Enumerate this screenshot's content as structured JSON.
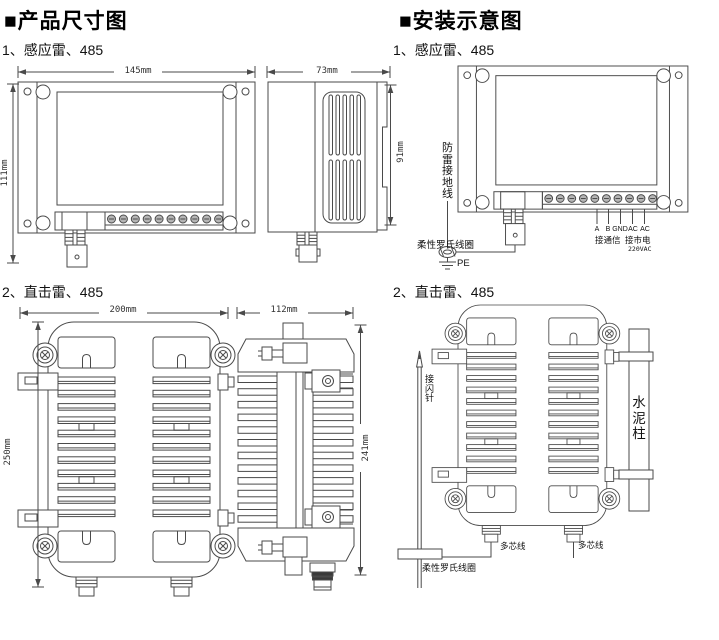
{
  "colors": {
    "line": "#4a4a4a",
    "text": "#111111",
    "screw_fill": "#b5b5b5",
    "dark_band": "#3a3a3a"
  },
  "headings": {
    "product_dimensions": "■产品尺寸图",
    "installation": "■安装示意图"
  },
  "subtitles": {
    "s1_left": "1、感应雷、485",
    "s1_right": "1、感应雷、485",
    "s2_left": "2、直击雷、485",
    "s2_right": "2、直击雷、485"
  },
  "dimension_labels": {
    "front1_width": "145mm",
    "front1_height": "111mm",
    "side1_width": "73mm",
    "side1_height": "91mm",
    "front2_width": "200mm",
    "front2_height": "250mm",
    "side2_width": "112mm",
    "side2_height": "241mm"
  },
  "install1_labels": {
    "lightning_ground_wire": "防雷接地线",
    "rogowski_coil": "柔性罗氏线圈",
    "pe": "PE",
    "terminal_1": "A",
    "terminal_2": "B",
    "terminal_3": "GND",
    "terminal_4": "AC",
    "terminal_5": "AC",
    "comm_port": "接通信",
    "mains_port": "接市电",
    "mains_voltage": "220VAC"
  },
  "install2_labels": {
    "air_terminal_rod": "接闪针",
    "cement_pillar": "水泥柱",
    "multicore_wire_left": "多芯线",
    "multicore_wire_right": "多芯线",
    "rogowski_coil": "柔性罗氏线圈"
  }
}
